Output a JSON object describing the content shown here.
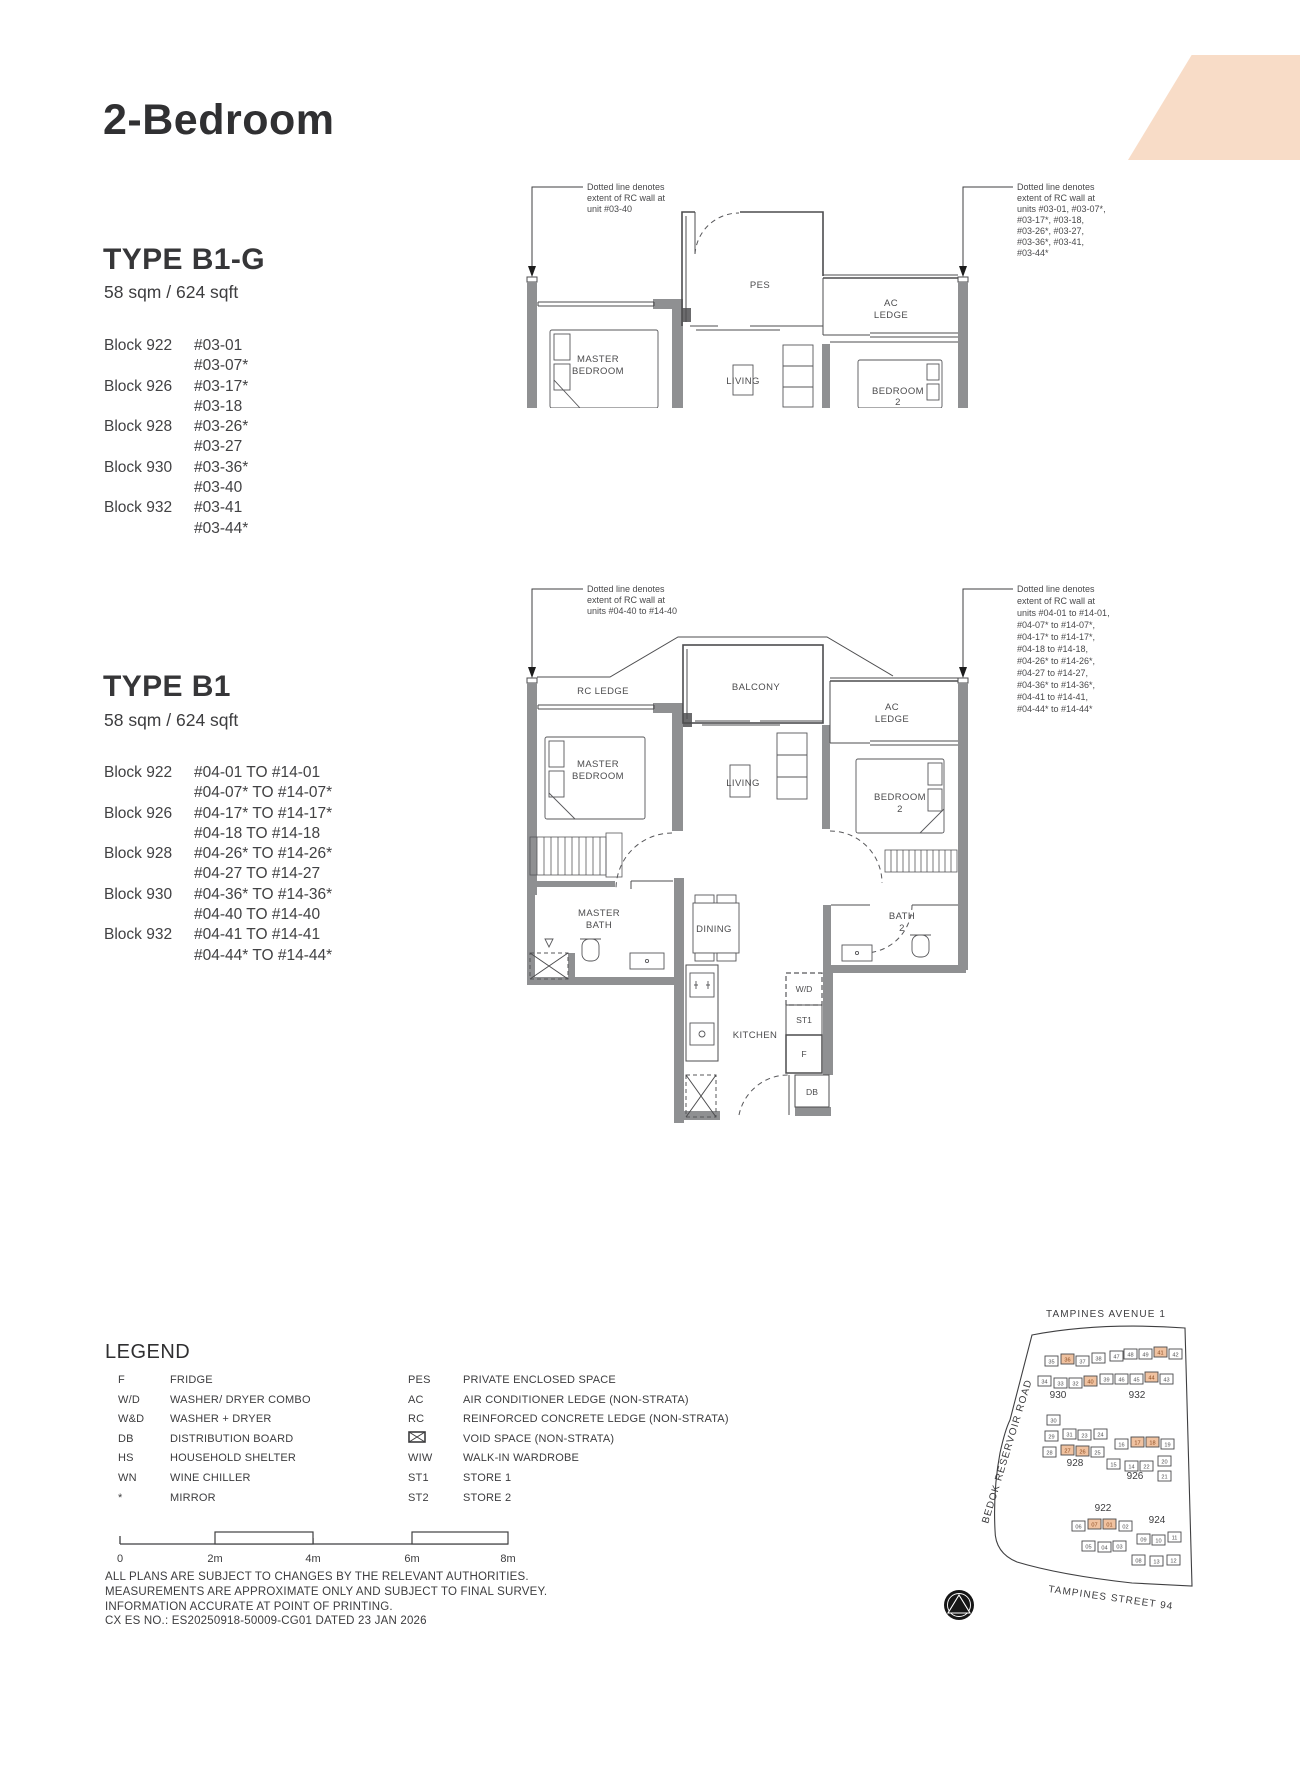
{
  "page": {
    "title": "2-Bedroom"
  },
  "type_b1g": {
    "name": "TYPE B1-G",
    "area": "58 sqm / 624 sqft",
    "blocks": [
      {
        "block": "Block 922",
        "units": [
          "#03-01",
          "#03-07*"
        ]
      },
      {
        "block": "Block 926",
        "units": [
          "#03-17*",
          "#03-18"
        ]
      },
      {
        "block": "Block 928",
        "units": [
          "#03-26*",
          "#03-27"
        ]
      },
      {
        "block": "Block 930",
        "units": [
          "#03-36*",
          "#03-40"
        ]
      },
      {
        "block": "Block 932",
        "units": [
          "#03-41",
          "#03-44*"
        ]
      }
    ],
    "ann_left": [
      "Dotted line denotes",
      "extent of RC wall at",
      "unit #03-40"
    ],
    "ann_right": [
      "Dotted line denotes",
      "extent of RC wall at",
      "units #03-01, #03-07*,",
      "#03-17*, #03-18,",
      "#03-26*, #03-27,",
      "#03-36*, #03-41,",
      "#03-44*"
    ],
    "rooms": {
      "pes": "PES",
      "master_bedroom": [
        "MASTER",
        "BEDROOM"
      ],
      "living": "LIVING",
      "ac_ledge": [
        "AC",
        "LEDGE"
      ],
      "bedroom2": [
        "BEDROOM",
        "2"
      ]
    }
  },
  "type_b1": {
    "name": "TYPE B1",
    "area": "58 sqm / 624 sqft",
    "blocks": [
      {
        "block": "Block 922",
        "units": [
          "#04-01 TO #14-01",
          "#04-07* TO #14-07*"
        ]
      },
      {
        "block": "Block 926",
        "units": [
          "#04-17* TO #14-17*",
          "#04-18 TO #14-18"
        ]
      },
      {
        "block": "Block 928",
        "units": [
          "#04-26* TO #14-26*",
          "#04-27 TO #14-27"
        ]
      },
      {
        "block": "Block 930",
        "units": [
          "#04-36* TO #14-36*",
          "#04-40 TO #14-40"
        ]
      },
      {
        "block": "Block 932",
        "units": [
          "#04-41 TO #14-41",
          "#04-44* TO #14-44*"
        ]
      }
    ],
    "ann_left": [
      "Dotted line denotes",
      "extent of RC wall at",
      "units #04-40 to #14-40"
    ],
    "ann_right": [
      "Dotted line denotes",
      "extent of RC wall at",
      "units #04-01 to #14-01,",
      "#04-07* to #14-07*,",
      "#04-17* to #14-17*,",
      "#04-18 to #14-18,",
      "#04-26* to #14-26*,",
      "#04-27 to #14-27,",
      "#04-36* to #14-36*,",
      "#04-41 to #14-41,",
      "#04-44* to #14-44*"
    ],
    "rooms": {
      "rc_ledge": "RC LEDGE",
      "balcony": "BALCONY",
      "ac_ledge": [
        "AC",
        "LEDGE"
      ],
      "master_bedroom": [
        "MASTER",
        "BEDROOM"
      ],
      "living": "LIVING",
      "bedroom2": [
        "BEDROOM",
        "2"
      ],
      "master_bath": [
        "MASTER",
        "BATH"
      ],
      "dining": "DINING",
      "bath2": [
        "BATH",
        "2"
      ],
      "kitchen": "KITCHEN",
      "wd": "W/D",
      "st1": "ST1",
      "f": "F",
      "db": "DB"
    }
  },
  "legend": {
    "title": "LEGEND",
    "col1": [
      {
        "abbr": "F",
        "desc": "FRIDGE"
      },
      {
        "abbr": "W/D",
        "desc": "WASHER/ DRYER COMBO"
      },
      {
        "abbr": "W&D",
        "desc": "WASHER + DRYER"
      },
      {
        "abbr": "DB",
        "desc": "DISTRIBUTION BOARD"
      },
      {
        "abbr": "HS",
        "desc": "HOUSEHOLD SHELTER"
      },
      {
        "abbr": "WN",
        "desc": "WINE CHILLER"
      },
      {
        "abbr": "*",
        "desc": "MIRROR"
      }
    ],
    "col2": [
      {
        "abbr": "PES",
        "desc": "PRIVATE ENCLOSED SPACE"
      },
      {
        "abbr": "AC",
        "desc": "AIR CONDITIONER LEDGE (NON-STRATA)"
      },
      {
        "abbr": "RC",
        "desc": "REINFORCED CONCRETE LEDGE (NON-STRATA)"
      },
      {
        "abbr": "",
        "icon": "void-space-box",
        "desc": "VOID SPACE (NON-STRATA)"
      },
      {
        "abbr": "WIW",
        "desc": "WALK-IN WARDROBE"
      },
      {
        "abbr": "ST1",
        "desc": "STORE 1"
      },
      {
        "abbr": "ST2",
        "desc": "STORE 2"
      }
    ]
  },
  "scale_bar": {
    "labels": [
      "0",
      "2m",
      "4m",
      "6m",
      "8m"
    ]
  },
  "disclaimer": [
    "ALL PLANS ARE SUBJECT TO CHANGES BY THE RELEVANT AUTHORITIES.",
    "MEASUREMENTS ARE APPROXIMATE ONLY AND SUBJECT TO FINAL SURVEY.",
    "INFORMATION ACCURATE AT POINT OF PRINTING.",
    "CX ES NO.: ES20250918-50009-CG01 DATED 23 JAN 2026"
  ],
  "site_map": {
    "roads": {
      "top": "TAMPINES AVENUE 1",
      "left": "BEDOK RESERVOIR ROAD",
      "bottom": "TAMPINES STREET 94"
    },
    "highlight_color": "#f0c2a0",
    "north_arrow": "north-arrow",
    "blocks": [
      {
        "label": "930",
        "lx": 158,
        "ly": 108,
        "units": [
          {
            "n": "35",
            "x": 145,
            "y": 66
          },
          {
            "n": "36",
            "x": 161,
            "y": 64,
            "hl": true
          },
          {
            "n": "37",
            "x": 176,
            "y": 66
          },
          {
            "n": "38",
            "x": 192,
            "y": 63
          },
          {
            "n": "34",
            "x": 138,
            "y": 86
          },
          {
            "n": "33",
            "x": 154,
            "y": 88
          },
          {
            "n": "32",
            "x": 169,
            "y": 88
          },
          {
            "n": "40",
            "x": 184,
            "y": 86,
            "hl": true
          },
          {
            "n": "39",
            "x": 200,
            "y": 84
          }
        ]
      },
      {
        "label": "932",
        "lx": 237,
        "ly": 108,
        "units": [
          {
            "n": "47",
            "x": 210,
            "y": 61
          },
          {
            "n": "48",
            "x": 224,
            "y": 59
          },
          {
            "n": "49",
            "x": 239,
            "y": 59
          },
          {
            "n": "41",
            "x": 254,
            "y": 57,
            "hl": true
          },
          {
            "n": "42",
            "x": 269,
            "y": 59
          },
          {
            "n": "46",
            "x": 215,
            "y": 84
          },
          {
            "n": "45",
            "x": 230,
            "y": 84
          },
          {
            "n": "44",
            "x": 245,
            "y": 82,
            "hl": true
          },
          {
            "n": "43",
            "x": 260,
            "y": 84
          }
        ]
      },
      {
        "label": "928",
        "lx": 175,
        "ly": 176,
        "units": [
          {
            "n": "30",
            "x": 147,
            "y": 125
          },
          {
            "n": "29",
            "x": 145,
            "y": 141
          },
          {
            "n": "31",
            "x": 163,
            "y": 139
          },
          {
            "n": "23",
            "x": 178,
            "y": 140
          },
          {
            "n": "24",
            "x": 194,
            "y": 139
          },
          {
            "n": "28",
            "x": 143,
            "y": 157
          },
          {
            "n": "27",
            "x": 161,
            "y": 155,
            "hl": true
          },
          {
            "n": "26",
            "x": 176,
            "y": 156,
            "hl": true
          },
          {
            "n": "25",
            "x": 191,
            "y": 157
          }
        ]
      },
      {
        "label": "926",
        "lx": 235,
        "ly": 189,
        "units": [
          {
            "n": "16",
            "x": 215,
            "y": 149
          },
          {
            "n": "17",
            "x": 231,
            "y": 147,
            "hl": true
          },
          {
            "n": "18",
            "x": 246,
            "y": 147,
            "hl": true
          },
          {
            "n": "19",
            "x": 261,
            "y": 149
          },
          {
            "n": "15",
            "x": 207,
            "y": 169
          },
          {
            "n": "14",
            "x": 225,
            "y": 171
          },
          {
            "n": "22",
            "x": 240,
            "y": 171
          },
          {
            "n": "20",
            "x": 258,
            "y": 166
          },
          {
            "n": "21",
            "x": 258,
            "y": 181
          }
        ]
      },
      {
        "label": "922",
        "lx": 203,
        "ly": 221,
        "units": [
          {
            "n": "06",
            "x": 172,
            "y": 231
          },
          {
            "n": "07",
            "x": 188,
            "y": 229,
            "hl": true
          },
          {
            "n": "01",
            "x": 203,
            "y": 229,
            "hl": true
          },
          {
            "n": "02",
            "x": 219,
            "y": 231
          },
          {
            "n": "05",
            "x": 182,
            "y": 251
          },
          {
            "n": "04",
            "x": 198,
            "y": 252
          },
          {
            "n": "03",
            "x": 213,
            "y": 251
          }
        ]
      },
      {
        "label": "924",
        "lx": 257,
        "ly": 233,
        "units": [
          {
            "n": "09",
            "x": 237,
            "y": 244
          },
          {
            "n": "10",
            "x": 252,
            "y": 245
          },
          {
            "n": "11",
            "x": 268,
            "y": 242
          },
          {
            "n": "08",
            "x": 232,
            "y": 265
          },
          {
            "n": "13",
            "x": 250,
            "y": 266
          },
          {
            "n": "12",
            "x": 267,
            "y": 265
          }
        ]
      }
    ]
  }
}
